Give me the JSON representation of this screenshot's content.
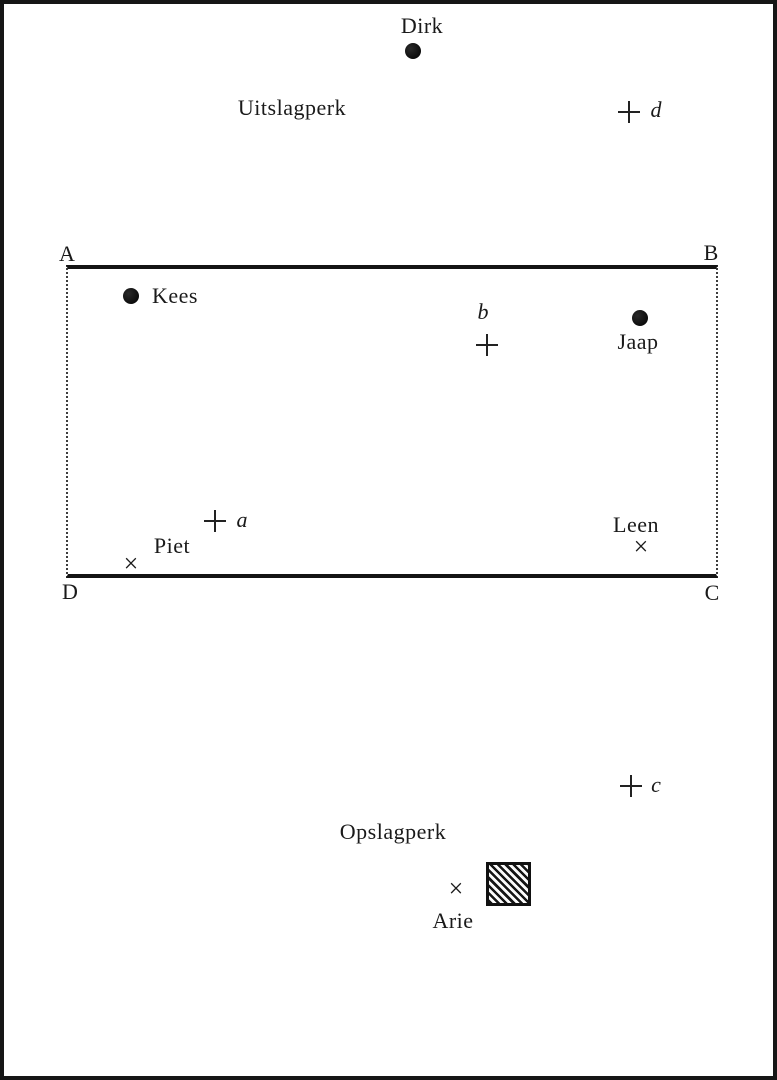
{
  "diagram": {
    "description": "Field diagram with players and marked points",
    "zones": {
      "uitslagperk": "Uitslagperk",
      "opslagperk": "Opslagperk"
    },
    "field_corners": {
      "top_left": "A",
      "top_right": "B",
      "bottom_right": "C",
      "bottom_left": "D"
    },
    "players": {
      "dirk": "Dirk",
      "kees": "Kees",
      "jaap": "Jaap",
      "piet": "Piet",
      "leen": "Leen",
      "arie": "Arie"
    },
    "target_points": {
      "a": "a",
      "b": "b",
      "c": "c",
      "d": "d"
    },
    "glyphs": {
      "plus": "+",
      "cross": "×",
      "filled_dot": "●"
    },
    "colors": {
      "ink": "#1a1a1a",
      "paper": "#ffffff"
    }
  }
}
